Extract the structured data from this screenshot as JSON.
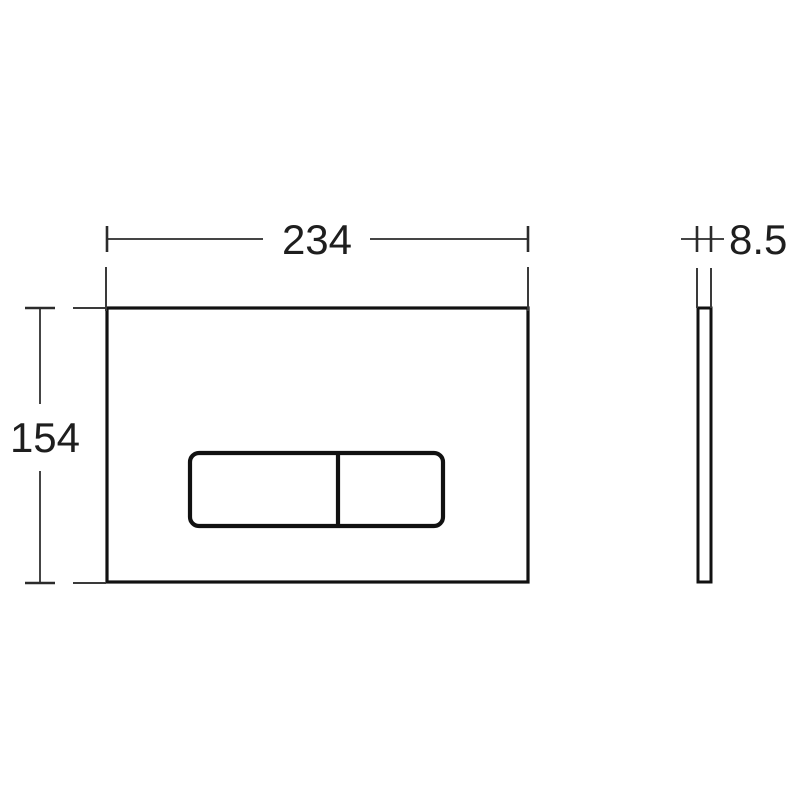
{
  "drawing": {
    "title": "flush-plate-dimension-drawing",
    "background_color": "#ffffff",
    "object_line_color": "#111111",
    "dimension_line_color": "#454545",
    "label_color": "#1e1e1e",
    "dimensions": {
      "width_label": "234",
      "height_label": "154",
      "thickness_label": "8.5"
    }
  }
}
